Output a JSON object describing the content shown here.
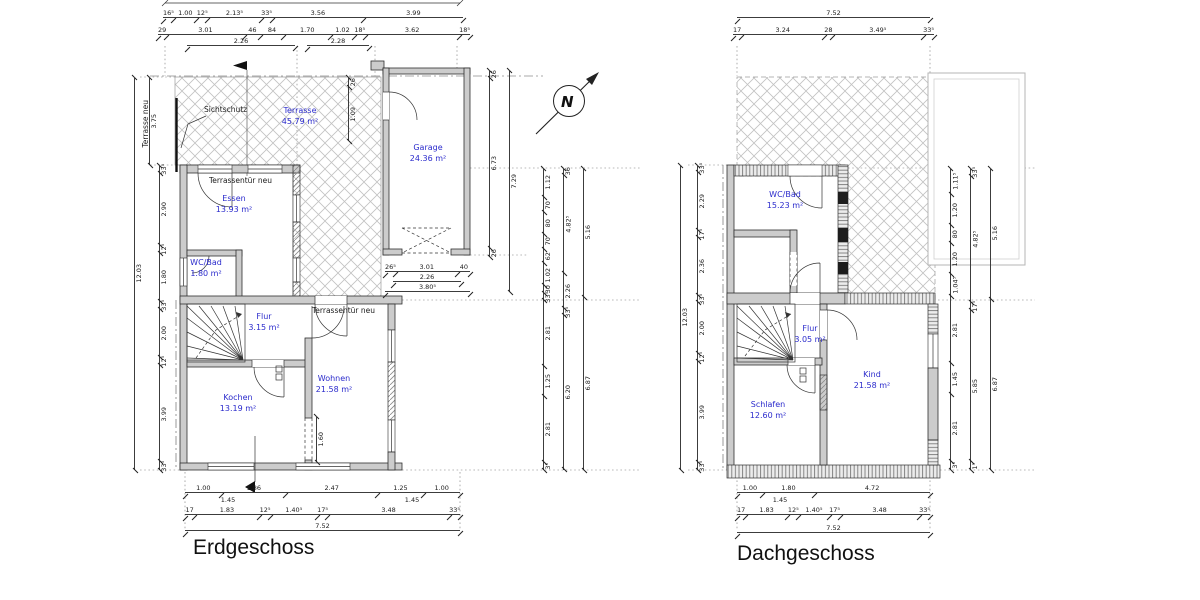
{
  "meta": {
    "room_label_color": "#2b2bcc",
    "wall_fill": "#cccccc",
    "line_color": "#3c3c3c",
    "background": "#ffffff"
  },
  "north": {
    "label": "N"
  },
  "erdgeschoss": {
    "title": "Erdgeschoss",
    "annotations": {
      "sichtschutz": "Sichtschutz",
      "terrasse_neu": "Terrasse neu",
      "terrassentuer_1": "Terrassentür neu",
      "terrassentuer_2": "Terrassentür neu"
    },
    "rooms": {
      "terrasse": {
        "name": "Terrasse",
        "area": "45.79 m²"
      },
      "garage": {
        "name": "Garage",
        "area": "24.36 m²"
      },
      "essen": {
        "name": "Essen",
        "area": "13.93 m²"
      },
      "wc": {
        "name": "WC/Bad",
        "area": "1.80 m²"
      },
      "flur": {
        "name": "Flur",
        "area": "3.15 m²"
      },
      "kochen": {
        "name": "Kochen",
        "area": "13.19 m²"
      },
      "wohnen": {
        "name": "Wohnen",
        "area": "21.58 m²"
      }
    },
    "dims": {
      "top1": [
        "16⁵",
        "1.00",
        "12⁵",
        "2.13⁵",
        "33⁵",
        "3.56",
        "3.99"
      ],
      "top2": [
        "29",
        "3.01",
        "46",
        "84",
        "1.70",
        "1.02",
        "18⁵",
        "3.62",
        "18⁵"
      ],
      "top3a": [
        "2.26"
      ],
      "top3b": [
        "2.28"
      ],
      "left_total": [
        "12.03"
      ],
      "left_terrasse": [
        "3.75"
      ],
      "left_rooms": [
        "33⁵",
        "2.90",
        "12⁵",
        "1.80",
        "33⁵",
        "2.00",
        "12⁵",
        "3.99",
        "33⁵"
      ],
      "right1": [
        "1.12",
        "70",
        "80",
        "70",
        "62",
        "1.02",
        "30",
        "33⁵",
        "2.81",
        "1.25",
        "2.81",
        "3⁵"
      ],
      "right2": [
        "36",
        "4.82⁵",
        "2.26",
        "33⁵",
        "6.20"
      ],
      "right3": [
        "5.16",
        "6.87"
      ],
      "garage_v1": [
        "26",
        "6.73",
        "26"
      ],
      "garage_v2": [
        "7.29"
      ],
      "terrace_v": [
        "26",
        "1.09"
      ],
      "opening_v": [
        "1.60"
      ],
      "garage_b1": [
        "26⁵",
        "3.01",
        "40"
      ],
      "garage_b2": [
        "2.26"
      ],
      "garage_b3": [
        "3.80⁵"
      ],
      "bottom1": [
        "1.00",
        "1.86",
        "2.47",
        "1.25",
        "1.00"
      ],
      "bottom2a": [
        "1.45"
      ],
      "bottom2b": [
        "1.45"
      ],
      "bottom3": [
        "17",
        "1.83",
        "12⁵",
        "1.40⁵",
        "17⁵",
        "3.48",
        "33⁵"
      ],
      "bottom_total": [
        "7.52"
      ]
    }
  },
  "dachgeschoss": {
    "title": "Dachgeschoss",
    "rooms": {
      "wc": {
        "name": "WC/Bad",
        "area": "15.23 m²"
      },
      "flur": {
        "name": "Flur",
        "area": "3.05 m²"
      },
      "schlafen": {
        "name": "Schlafen",
        "area": "12.60 m²"
      },
      "kind": {
        "name": "Kind",
        "area": "21.58 m²"
      }
    },
    "dims": {
      "top_total": [
        "7.52"
      ],
      "top2": [
        "17",
        "3.24",
        "28",
        "3.49⁵",
        "33⁵"
      ],
      "left_total": [
        "12.03"
      ],
      "left_rooms": [
        "33⁵",
        "2.29",
        "17⁵",
        "2.36",
        "33⁵",
        "2.00",
        "12⁵",
        "3.99",
        "33⁵"
      ],
      "right1": [
        "1.11⁵",
        "1.20",
        "80",
        "1.20",
        "1.04⁵",
        "2.81",
        "1.45",
        "2.81",
        "3⁵"
      ],
      "right2": [
        "33⁵",
        "4.82⁵",
        "17⁵",
        "5.85",
        "1⁵"
      ],
      "right3": [
        "5.16",
        "6.87"
      ],
      "bottom1": [
        "1.00",
        "1.80",
        "4.72"
      ],
      "bottom2": [
        "1.45"
      ],
      "bottom3": [
        "17",
        "1.83",
        "12⁵",
        "1.40⁵",
        "17⁵",
        "3.48",
        "33⁵"
      ],
      "bottom_total": [
        "7.52"
      ]
    }
  }
}
